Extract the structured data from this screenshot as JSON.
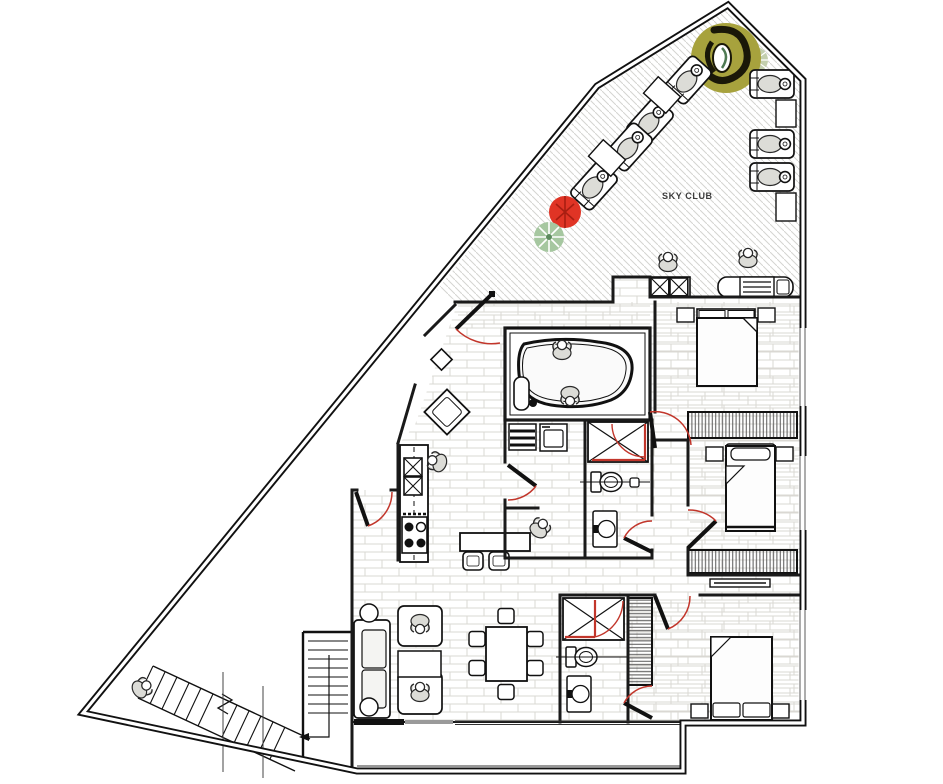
{
  "labels": {
    "terrace": "SKY CLUB"
  },
  "colors": {
    "wall": "#1a1a1a",
    "accent_red": "#c2362b",
    "plant_red": "#e03425",
    "plant_green": "#a6c7a0",
    "tree_olive": "#a7a23d",
    "tree_dark": "#1a1808",
    "tree_pale": "#c3cfae",
    "floor_line": "#dad8d3",
    "hatch_line": "#d4d4d1",
    "wardrobe_line": "#565656",
    "person": "#dcdcd7",
    "paper": "#ffffff"
  }
}
